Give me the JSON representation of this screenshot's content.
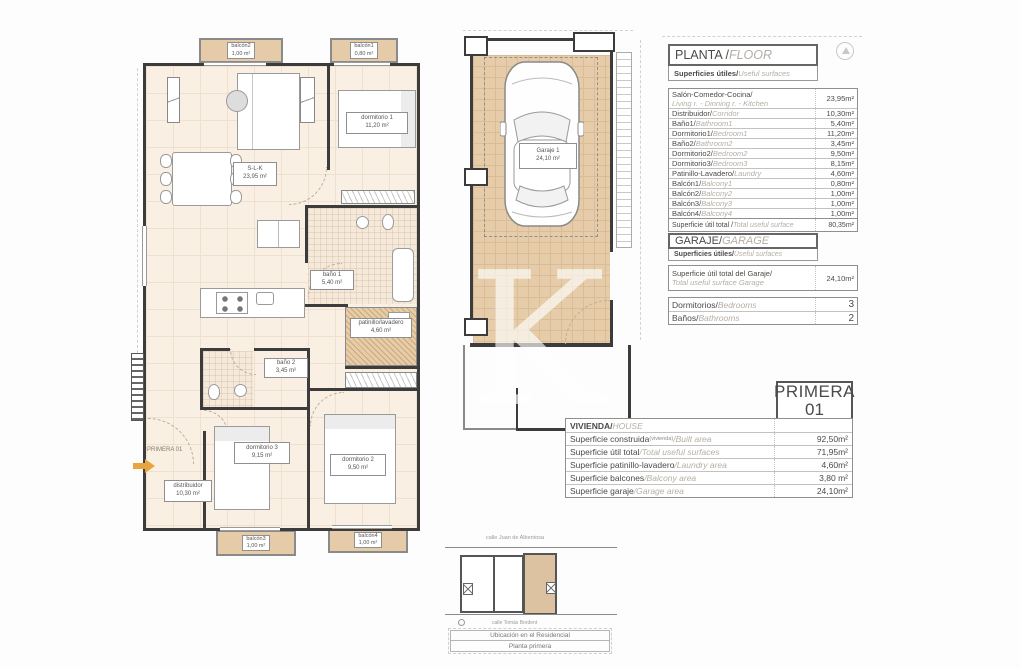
{
  "sheet": {
    "watermark_letter": "K"
  },
  "floor_panel": {
    "title_es": "PLANTA / ",
    "title_en": "FLOOR",
    "subtitle_es": "Superficies útiles/",
    "subtitle_en": "Useful surfaces",
    "rows": [
      {
        "es": "Salón-Comedor-Cocina/",
        "en": "Living r. - Dinning r. - Kitchen",
        "value": "23,95m²"
      },
      {
        "es": "Distribuidor/",
        "en": "Corridor",
        "value": "10,30m²"
      },
      {
        "es": "Baño1/",
        "en": "Bathroom1",
        "value": "5,40m²"
      },
      {
        "es": "Dormitorio1/",
        "en": "Bedroom1",
        "value": "11,20m²"
      },
      {
        "es": "Baño2/",
        "en": "Bathroom2",
        "value": "3,45m²"
      },
      {
        "es": "Dormitorio2/",
        "en": "Bedroom2",
        "value": "9,50m²"
      },
      {
        "es": "Dormitorio3/",
        "en": "Bedroom3",
        "value": "8,15m²"
      },
      {
        "es": "Patinillo-Lavadero/",
        "en": "Laundry",
        "value": "4,60m²"
      },
      {
        "es": "Balcón1/",
        "en": "Balcony1",
        "value": "0,80m²"
      },
      {
        "es": "Balcón2/",
        "en": "Balcony2",
        "value": "1,00m²"
      },
      {
        "es": "Balcón3/",
        "en": "Balcony3",
        "value": "1,00m²"
      },
      {
        "es": "Balcón4/",
        "en": "Balcony4",
        "value": "1,00m²"
      }
    ],
    "total": {
      "es": "Superficie útil total / ",
      "en": "Total useful surface",
      "value": "80,35m²"
    }
  },
  "garage_panel": {
    "title_es": "GARAJE/",
    "title_en": "GARAGE",
    "subtitle_es": "Superficies útiles/",
    "subtitle_en": "Useful surfaces",
    "total_es": "Superficie útil total del Garaje/",
    "total_en": "Total useful surface Garage",
    "total_value": "24,10m²",
    "bedrooms_es": "Dormitorios/",
    "bedrooms_en": "Bedrooms",
    "bedrooms_value": "3",
    "bathrooms_es": "Baños/",
    "bathrooms_en": "Bathrooms",
    "bathrooms_value": "2"
  },
  "title_block": {
    "line1": "PRIMERA",
    "line2": "01"
  },
  "house_panel": {
    "header_es": "VIVIENDA/",
    "header_en": "HOUSE",
    "rows": [
      {
        "es": "Superficie construida",
        "small": "(vivienda)",
        "en": "/Built area",
        "value": "92,50m²"
      },
      {
        "es": "Superficie útil total",
        "en": "/Total useful surfaces",
        "value": "71,95m²"
      },
      {
        "es": "Superficie patinillo-lavadero",
        "en": "/Laundry area",
        "value": "4,60m²"
      },
      {
        "es": "Superficie balcones",
        "en": "/Balcony area",
        "value": "3,80 m²"
      },
      {
        "es": "Superficie garaje",
        "en": "/Garage area",
        "value": "24,10m²"
      }
    ]
  },
  "plan": {
    "entry_label": "PRIMERA 01",
    "rooms": {
      "slk": {
        "name": "S-L-K",
        "area": "23,95 m²"
      },
      "dorm1": {
        "name": "dormitorio 1",
        "area": "11,20 m²"
      },
      "bano1": {
        "name": "baño 1",
        "area": "5,40 m²"
      },
      "bano2": {
        "name": "baño 2",
        "area": "3,45 m²"
      },
      "patinillo": {
        "name": "patinillo/lavadero",
        "area": "4,60 m²"
      },
      "dorm3": {
        "name": "dormitorio 3",
        "area": "9,15 m²"
      },
      "dorm2": {
        "name": "dormitorio 2",
        "area": "9,50 m²"
      },
      "distribuidor": {
        "name": "distribuidor",
        "area": "10,30 m²"
      },
      "balcon2": {
        "name": "balcón2",
        "area": "1,00 m²"
      },
      "balcon1": {
        "name": "balcón1",
        "area": "0,80 m²"
      },
      "balcon3": {
        "name": "balcón3",
        "area": "1,00 m²"
      },
      "balcon4": {
        "name": "balcón4",
        "area": "1,00 m²"
      }
    }
  },
  "garage_plan": {
    "name": "Garaje 1",
    "area": "24,10 m²"
  },
  "location": {
    "street_top": "calle Juan de Albentosa",
    "street_bottom": "calle Tomás Bordent",
    "caption_line1": "Ubicación en el Residencial",
    "caption_line2": "Planta primera"
  },
  "colors": {
    "room_fill": "#f9efe3",
    "balcony_fill": "#e5cba8",
    "garage_floor": "#e6cca8",
    "arrow_orange": "#e8a53f"
  }
}
